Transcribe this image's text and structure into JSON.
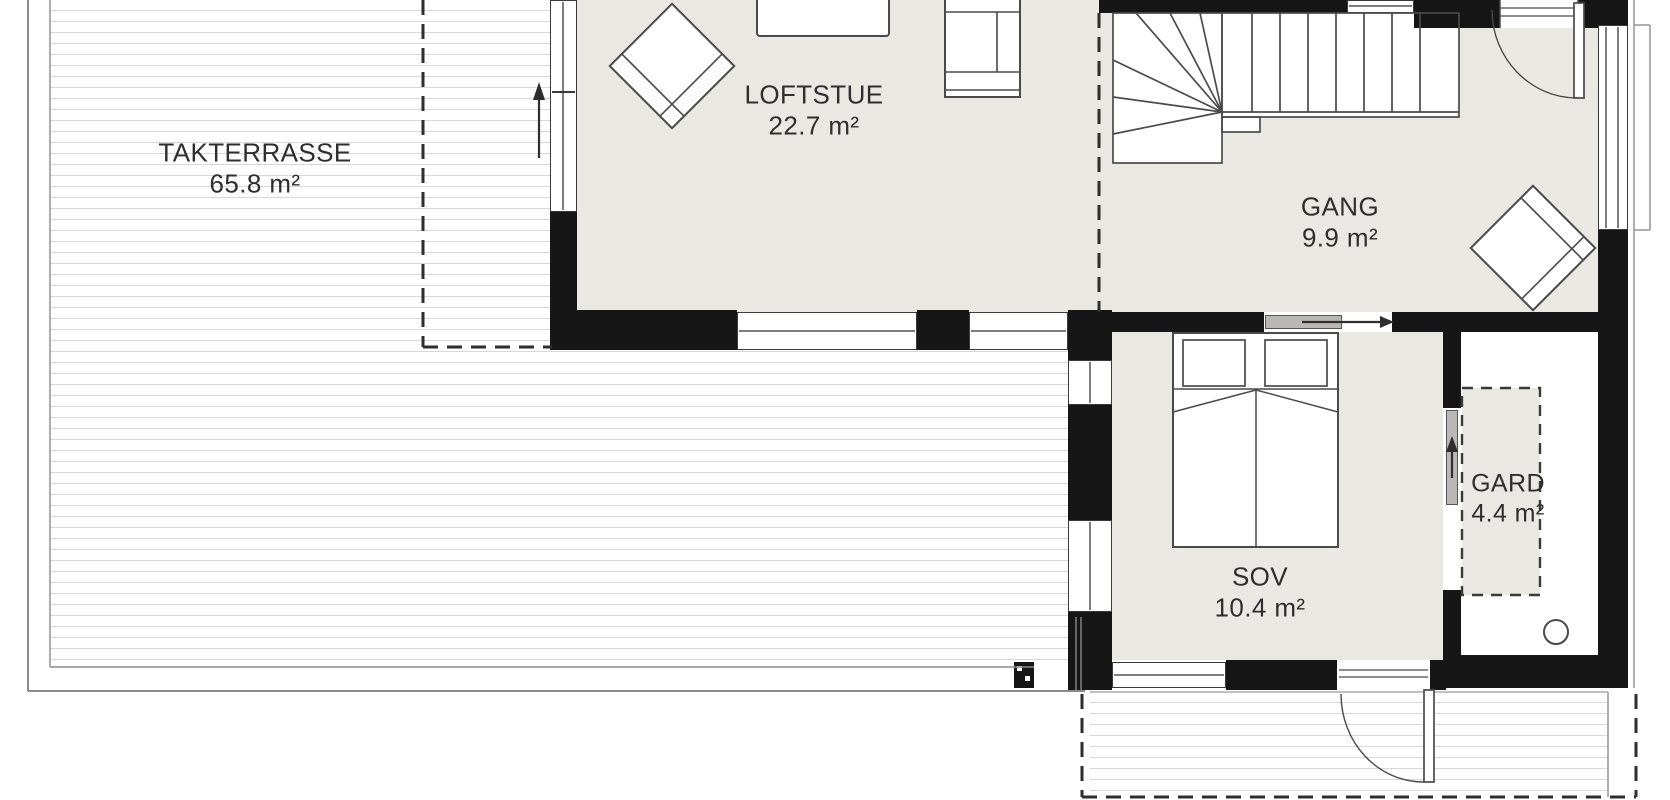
{
  "plan": {
    "rooms": [
      {
        "id": "takterrasse",
        "name": "TAKTERRASSE",
        "area": "65.8 m²"
      },
      {
        "id": "loftstue",
        "name": "LOFTSTUE",
        "area": "22.7 m²"
      },
      {
        "id": "gang",
        "name": "GANG",
        "area": "9.9 m²"
      },
      {
        "id": "sov",
        "name": "SOV",
        "area": "10.4 m²"
      },
      {
        "id": "gard",
        "name": "GARD",
        "area": "4.4 m²"
      }
    ],
    "colors": {
      "wall": "#161616",
      "room_floor": "#e9e8e3",
      "deck_line": "#d8d8d5",
      "outline": "#4a4a4a",
      "text": "#2e2e2e",
      "background": "#ffffff"
    }
  }
}
